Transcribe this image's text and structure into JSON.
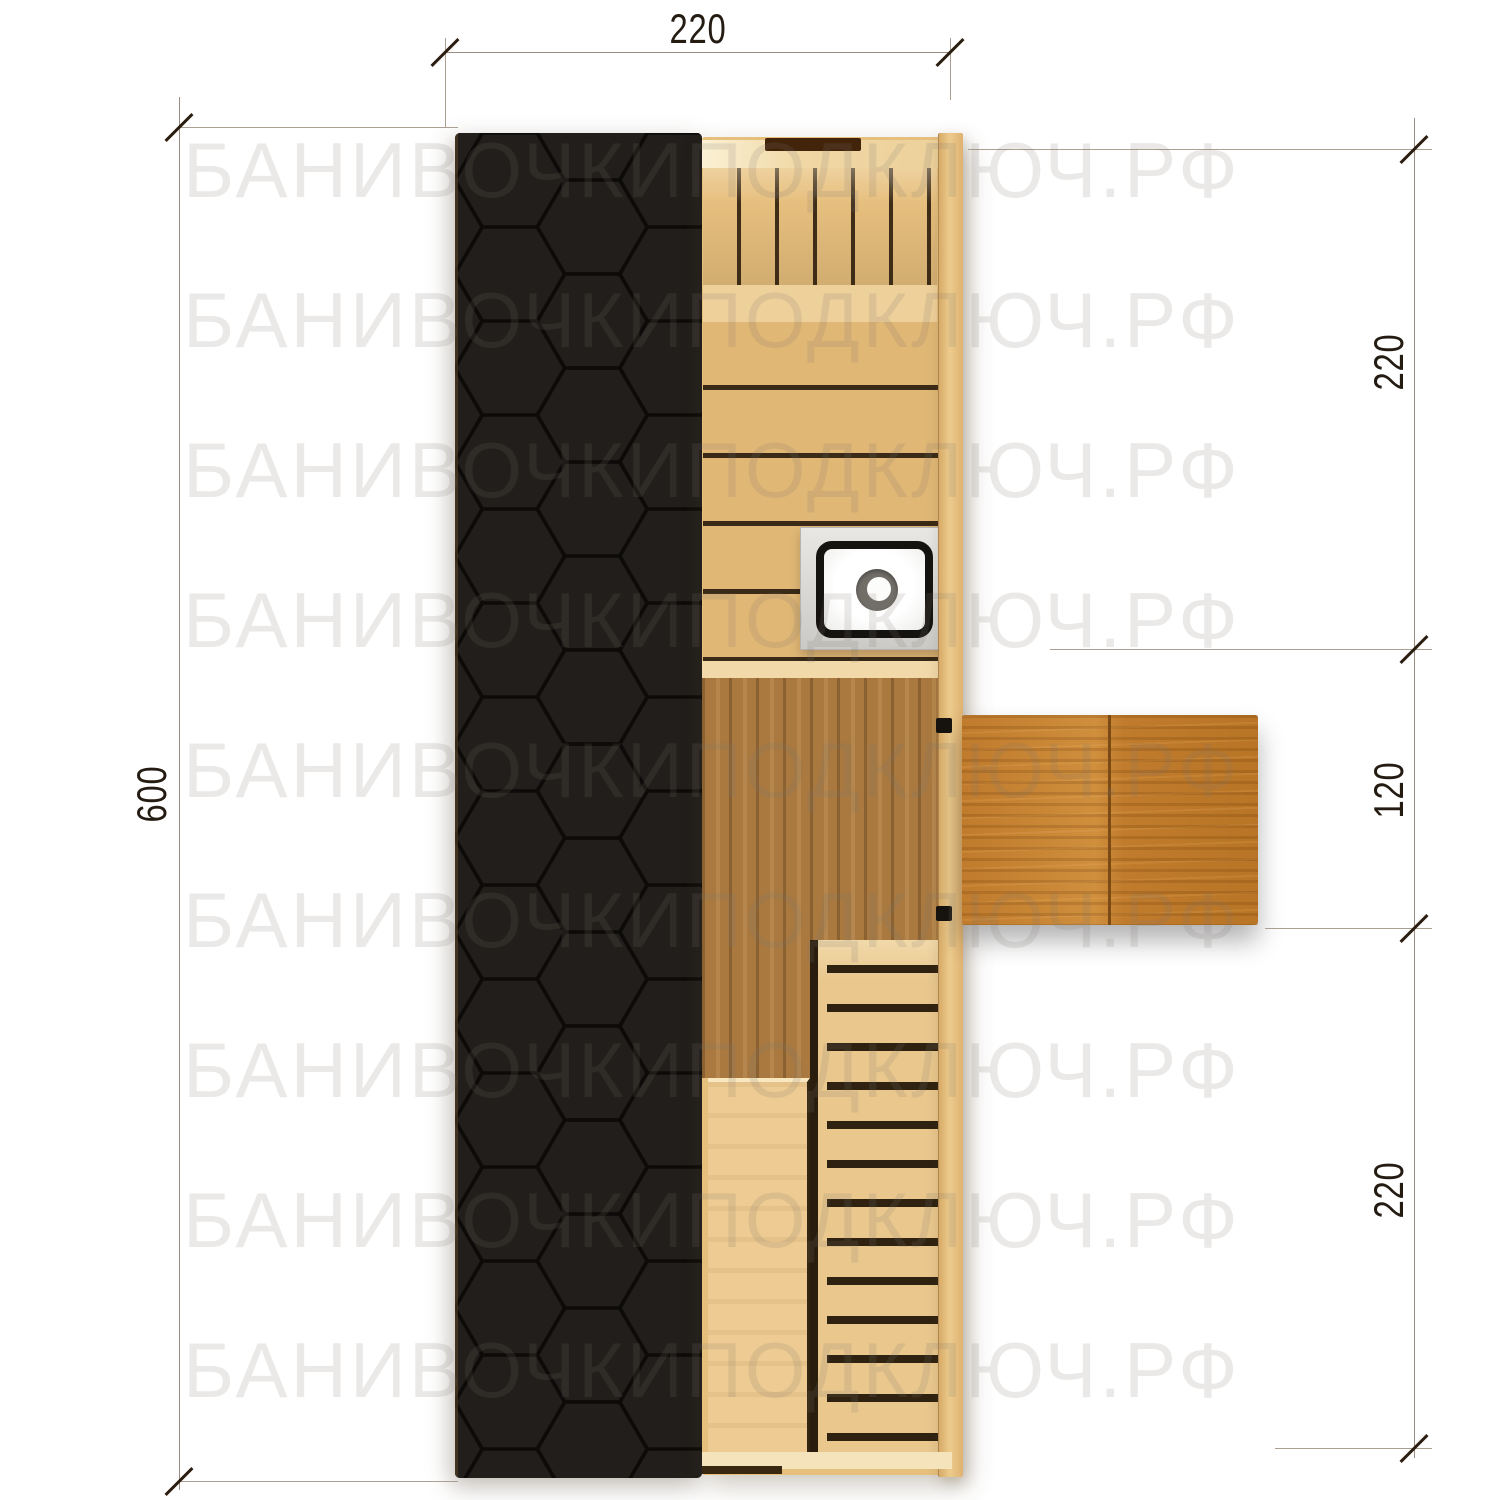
{
  "watermark": {
    "text": "БАНИВОЧКИПОДКЛЮЧ.РФ",
    "rows": 9,
    "color": "#ececea"
  },
  "dimensions": {
    "top": {
      "label": "220"
    },
    "left": {
      "label": "600"
    },
    "right": [
      {
        "label": "220"
      },
      {
        "label": "120"
      },
      {
        "label": "220"
      }
    ]
  },
  "plan": {
    "colors": {
      "roof_black": "#211e1b",
      "roof_hex_line": "#0d0b09",
      "wood_light": "#e6bf7d",
      "wood_bench": "#edcb92",
      "wood_floor_dark": "#a97940",
      "table_door": "#c07b2c",
      "plank_gap": "#3a2a17",
      "stove_plate": "#d9d8d5",
      "stove_rim": "#151310",
      "dimension_line": "#9a8d80",
      "dimension_text": "#241b12"
    }
  }
}
